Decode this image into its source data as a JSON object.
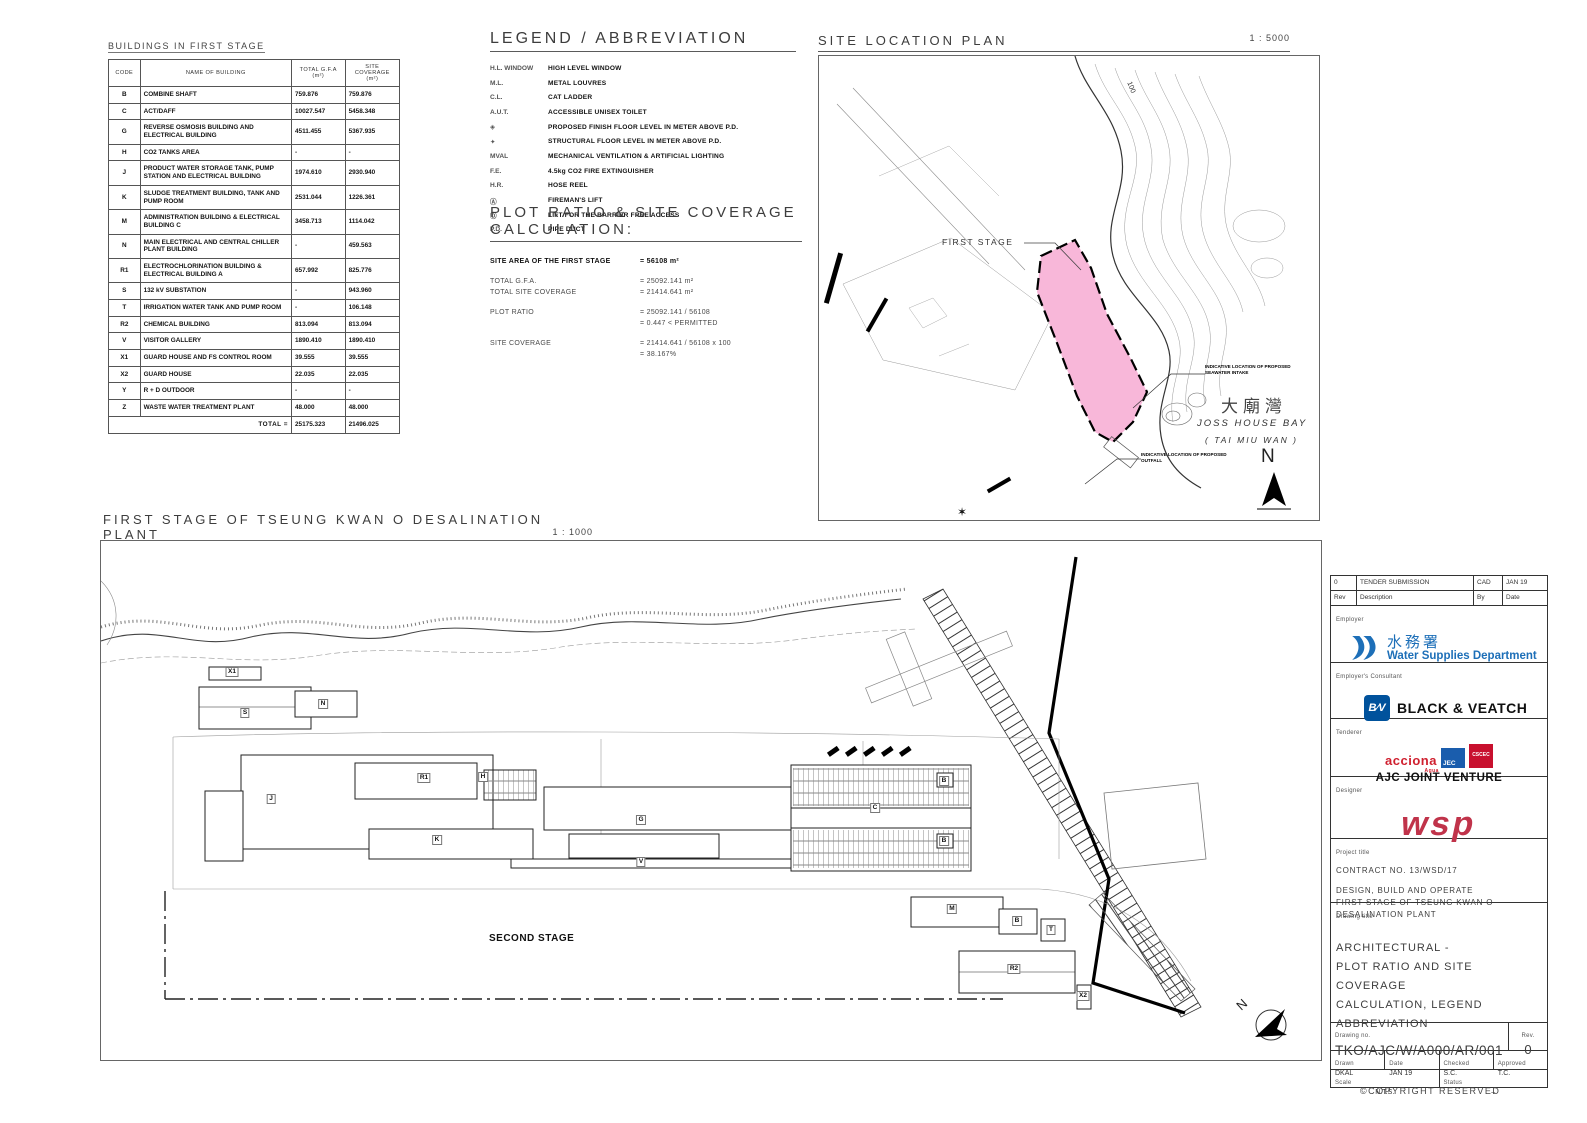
{
  "buildings_table": {
    "title": "BUILDINGS IN FIRST STAGE",
    "columns": [
      "CODE",
      "NAME OF BUILDING",
      "TOTAL G.F.A (m²)",
      "SITE COVERAGE (m²)"
    ],
    "rows": [
      {
        "code": "B",
        "name": "COMBINE SHAFT",
        "gfa": "759.876",
        "coverage": "759.876"
      },
      {
        "code": "C",
        "name": "ACT/DAFF",
        "gfa": "10027.547",
        "coverage": "5458.348"
      },
      {
        "code": "G",
        "name": "REVERSE OSMOSIS BUILDING AND ELECTRICAL BUILDING",
        "gfa": "4511.455",
        "coverage": "5367.935"
      },
      {
        "code": "H",
        "name": "CO2 TANKS AREA",
        "gfa": "-",
        "coverage": "-"
      },
      {
        "code": "J",
        "name": "PRODUCT WATER STORAGE TANK, PUMP STATION AND ELECTRICAL BUILDING",
        "gfa": "1974.610",
        "coverage": "2930.940"
      },
      {
        "code": "K",
        "name": "SLUDGE TREATMENT BUILDING, TANK AND PUMP ROOM",
        "gfa": "2531.044",
        "coverage": "1226.361"
      },
      {
        "code": "M",
        "name": "ADMINISTRATION BUILDING & ELECTRICAL BUILDING C",
        "gfa": "3458.713",
        "coverage": "1114.042"
      },
      {
        "code": "N",
        "name": "MAIN ELECTRICAL AND CENTRAL CHILLER PLANT BUILDING",
        "gfa": "-",
        "coverage": "459.563"
      },
      {
        "code": "R1",
        "name": "ELECTROCHLORINATION BUILDING & ELECTRICAL BUILDING A",
        "gfa": "657.992",
        "coverage": "825.776"
      },
      {
        "code": "S",
        "name": "132 kV SUBSTATION",
        "gfa": "-",
        "coverage": "943.960"
      },
      {
        "code": "T",
        "name": "IRRIGATION WATER TANK AND PUMP ROOM",
        "gfa": "-",
        "coverage": "106.148"
      },
      {
        "code": "R2",
        "name": "CHEMICAL BUILDING",
        "gfa": "813.094",
        "coverage": "813.094"
      },
      {
        "code": "V",
        "name": "VISITOR GALLERY",
        "gfa": "1890.410",
        "coverage": "1890.410"
      },
      {
        "code": "X1",
        "name": "GUARD HOUSE AND FS CONTROL ROOM",
        "gfa": "39.555",
        "coverage": "39.555"
      },
      {
        "code": "X2",
        "name": "GUARD HOUSE",
        "gfa": "22.035",
        "coverage": "22.035"
      },
      {
        "code": "Y",
        "name": "R + D OUTDOOR",
        "gfa": "-",
        "coverage": "-"
      },
      {
        "code": "Z",
        "name": "WASTE WATER TREATMENT PLANT",
        "gfa": "48.000",
        "coverage": "48.000"
      }
    ],
    "total_label": "TOTAL =",
    "total_gfa": "25175.323",
    "total_coverage": "21496.025"
  },
  "legend": {
    "title": "LEGEND / ABBREVIATION",
    "items": [
      {
        "abbr": "H.L. WINDOW",
        "desc": "HIGH LEVEL WINDOW"
      },
      {
        "abbr": "M.L.",
        "desc": "METAL LOUVRES"
      },
      {
        "abbr": "C.L.",
        "desc": "CAT LADDER"
      },
      {
        "abbr": "A.U.T.",
        "desc": "ACCESSIBLE UNISEX TOILET"
      },
      {
        "abbr": "◈",
        "desc": "PROPOSED FINISH FLOOR LEVEL IN METER ABOVE P.D."
      },
      {
        "abbr": "✦",
        "desc": "STRUCTURAL FLOOR LEVEL IN METER ABOVE P.D."
      },
      {
        "abbr": "MVAL",
        "desc": "MECHANICAL VENTILATION & ARTIFICIAL LIGHTING"
      },
      {
        "abbr": "F.E.",
        "desc": "4.5kg CO2 FIRE EXTINGUISHER"
      },
      {
        "abbr": "H.R.",
        "desc": "HOSE REEL"
      },
      {
        "abbr": "Ⓐ",
        "desc": "FIREMAN'S LIFT"
      },
      {
        "abbr": "Ⓓ",
        "desc": "LIFT FOR THE BARRIER FREE ACCESS"
      },
      {
        "abbr": "P.D.",
        "desc": "PIPE DUCT"
      }
    ]
  },
  "plot_ratio": {
    "title": "PLOT RATIO & SITE COVERAGE CALCULATION:",
    "rows": [
      {
        "l": "SITE AREA OF THE FIRST STAGE",
        "v": "=   56108 m²"
      },
      {
        "l": "TOTAL G.F.A.",
        "v": "=   25092.141 m²"
      },
      {
        "l": "TOTAL SITE COVERAGE",
        "v": "=   21414.641 m²"
      },
      {
        "l": "PLOT RATIO",
        "v": "=   25092.141 / 56108"
      },
      {
        "l": "",
        "v": "=   0.447   <   PERMITTED"
      },
      {
        "l": "SITE COVERAGE",
        "v": "=   21414.641 / 56108  x  100"
      },
      {
        "l": "",
        "v": "=   38.167%"
      }
    ]
  },
  "site_location": {
    "title": "SITE LOCATION PLAN",
    "scale": "1 : 5000",
    "first_stage": "FIRST STAGE",
    "bay_cn": "大廟灣",
    "bay_en": "JOSS HOUSE BAY",
    "bay_sub": "( TAI MIU WAN )",
    "callout_intake": "INDICATIVE LOCATION OF PROPOSED SEAWATER INTAKE",
    "callout_outfall": "INDICATIVE LOCATION OF PROPOSED OUTFALL",
    "contour_label": "100",
    "north": "N"
  },
  "main_plan": {
    "title": "FIRST STAGE OF TSEUNG KWAN O DESALINATION PLANT",
    "scale": "1 : 1000",
    "second_stage": "SECOND STAGE",
    "north": "N",
    "labels": [
      {
        "t": "X1",
        "x": 131,
        "y": 131
      },
      {
        "t": "S",
        "x": 144,
        "y": 172
      },
      {
        "t": "N",
        "x": 222,
        "y": 163
      },
      {
        "t": "J",
        "x": 170,
        "y": 258
      },
      {
        "t": "R1",
        "x": 323,
        "y": 237
      },
      {
        "t": "H",
        "x": 382,
        "y": 236
      },
      {
        "t": "K",
        "x": 336,
        "y": 299
      },
      {
        "t": "G",
        "x": 540,
        "y": 279
      },
      {
        "t": "V",
        "x": 540,
        "y": 321
      },
      {
        "t": "C",
        "x": 774,
        "y": 267
      },
      {
        "t": "B",
        "x": 843,
        "y": 240
      },
      {
        "t": "B",
        "x": 843,
        "y": 300
      },
      {
        "t": "M",
        "x": 851,
        "y": 368
      },
      {
        "t": "B",
        "x": 916,
        "y": 380
      },
      {
        "t": "T",
        "x": 950,
        "y": 389
      },
      {
        "t": "R2",
        "x": 913,
        "y": 428
      },
      {
        "t": "X2",
        "x": 982,
        "y": 455
      }
    ]
  },
  "title_block": {
    "revision": {
      "rows": [
        {
          "rev": "0",
          "desc": "TENDER SUBMISSION",
          "by": "CAD",
          "date": "JAN 19"
        },
        {
          "rev": "Rev",
          "desc": "Description",
          "by": "By",
          "date": "Date"
        }
      ]
    },
    "employer_label": "Employer",
    "employer_cn": "水務署",
    "employer_en": "Water Supplies Department",
    "consultant_label": "Employer's Consultant",
    "consultant_mark": "B⁄V",
    "consultant_name": "BLACK & VEATCH",
    "tenderer_label": "Tenderer",
    "tenderer_acciona": "acciona",
    "tenderer_acciona_sub": "Agua",
    "tenderer_jec": "JEC",
    "tenderer_cscec": "CSCEC",
    "tenderer_jv": "AJC JOINT VENTURE",
    "designer_label": "Designer",
    "designer_name": "wsp",
    "project_label": "Project title",
    "project_lines": [
      "CONTRACT NO. 13/WSD/17",
      "DESIGN, BUILD AND OPERATE",
      "FIRST STAGE OF TSEUNG KWAN O",
      "DESALINATION PLANT"
    ],
    "drawing_title_label": "Drawing title",
    "drawing_title_lines": [
      "ARCHITECTURAL -",
      "PLOT RATIO AND SITE COVERAGE",
      "CALCULATION, LEGEND",
      "ABBREVIATION"
    ],
    "drawing_no_label": "Drawing no.",
    "drawing_no": "TKO/AJC/W/A000/AR/001",
    "rev_label": "Rev.",
    "rev_value": "0",
    "drawn_label": "Drawn",
    "drawn_value": "DKAL",
    "date_label": "Date",
    "date_value": "JAN 19",
    "checked_label": "Checked",
    "checked_value": "S.C.",
    "approved_label": "Approved",
    "approved_value": "T.C.",
    "scale_label": "Scale",
    "scale_value": "N.T.S.",
    "status_label": "Status",
    "status_value": "–",
    "copyright": "©COPYRIGHT RESERVED"
  }
}
